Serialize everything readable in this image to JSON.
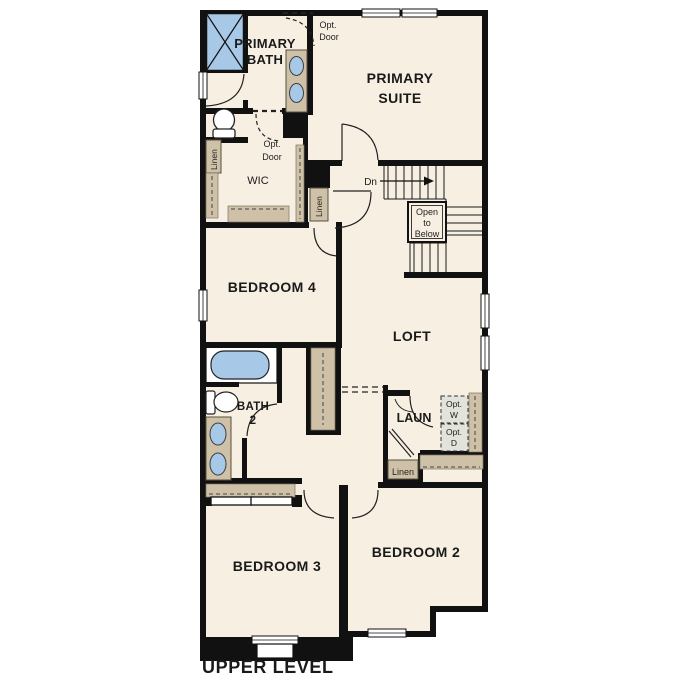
{
  "title": "UPPER LEVEL",
  "palette": {
    "floor": "#f7efe2",
    "wall": "#111111",
    "cabinet_tan": "#cfc1a7",
    "fixture_blue": "#a8c8e8",
    "appliance_gray": "#e2e3da",
    "white": "#ffffff"
  },
  "rooms": {
    "primary_bath": {
      "line1": "PRIMARY",
      "line2": "BATH"
    },
    "primary_suite": {
      "line1": "PRIMARY",
      "line2": "SUITE"
    },
    "wic": {
      "label": "WIC"
    },
    "bedroom4": {
      "label": "BEDROOM 4"
    },
    "loft": {
      "label": "LOFT"
    },
    "bath2": {
      "line1": "BATH",
      "line2": "2"
    },
    "laundry": {
      "label": "LAUN"
    },
    "bedroom3": {
      "label": "BEDROOM 3"
    },
    "bedroom2": {
      "label": "BEDROOM 2"
    }
  },
  "annotations": {
    "opt_door_upper": {
      "line1": "Opt.",
      "line2": "Door"
    },
    "opt_door_wic": {
      "line1": "Opt.",
      "line2": "Door"
    },
    "linen_bath": {
      "label": "Linen"
    },
    "linen_hall": {
      "label": "Linen"
    },
    "linen_laundry": {
      "label": "Linen"
    },
    "stair_direction": {
      "label": "Dn"
    },
    "open_to_below": {
      "line1": "Open",
      "line2": "to",
      "line3": "Below"
    },
    "opt_washer": {
      "line1": "Opt.",
      "line2": "W"
    },
    "opt_dryer": {
      "line1": "Opt.",
      "line2": "D"
    }
  }
}
